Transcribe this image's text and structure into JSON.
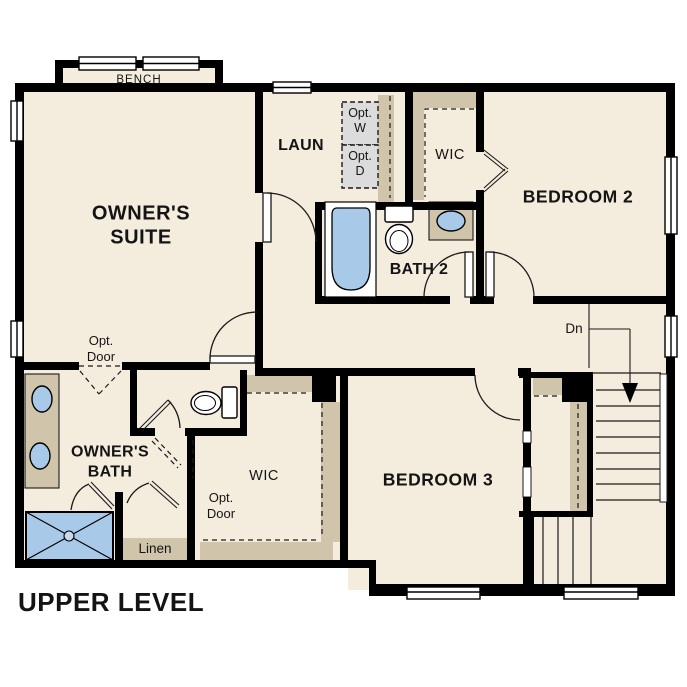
{
  "title": "UPPER LEVEL",
  "colors": {
    "floor": "#f4ecdd",
    "wall": "#000000",
    "builtin_tan": "#d0c5ab",
    "appliance_gray": "#dcdcdc",
    "fixture_blue": "#a9c9e9",
    "line": "#1a1a1a"
  },
  "rooms": {
    "owners_suite": {
      "line1": "OWNER'S",
      "line2": "SUITE"
    },
    "laundry": {
      "label": "LAUN"
    },
    "wic_upper": {
      "label": "WIC"
    },
    "bedroom2": {
      "label": "BEDROOM 2"
    },
    "bath2": {
      "label": "BATH 2"
    },
    "owners_bath": {
      "line1": "OWNER'S",
      "line2": "BATH"
    },
    "owners_wic": {
      "label": "WIC"
    },
    "bedroom3": {
      "label": "BEDROOM 3"
    },
    "linen": {
      "label": "Linen"
    }
  },
  "annotations": {
    "bench": "BENCH",
    "opt_washer": {
      "line1": "Opt.",
      "line2": "W"
    },
    "opt_dryer": {
      "line1": "Opt.",
      "line2": "D"
    },
    "opt_door_owners_bath": {
      "line1": "Opt.",
      "line2": "Door"
    },
    "opt_door_owners_wic": {
      "line1": "Opt.",
      "line2": "Door"
    },
    "stairs_down": "Dn"
  }
}
